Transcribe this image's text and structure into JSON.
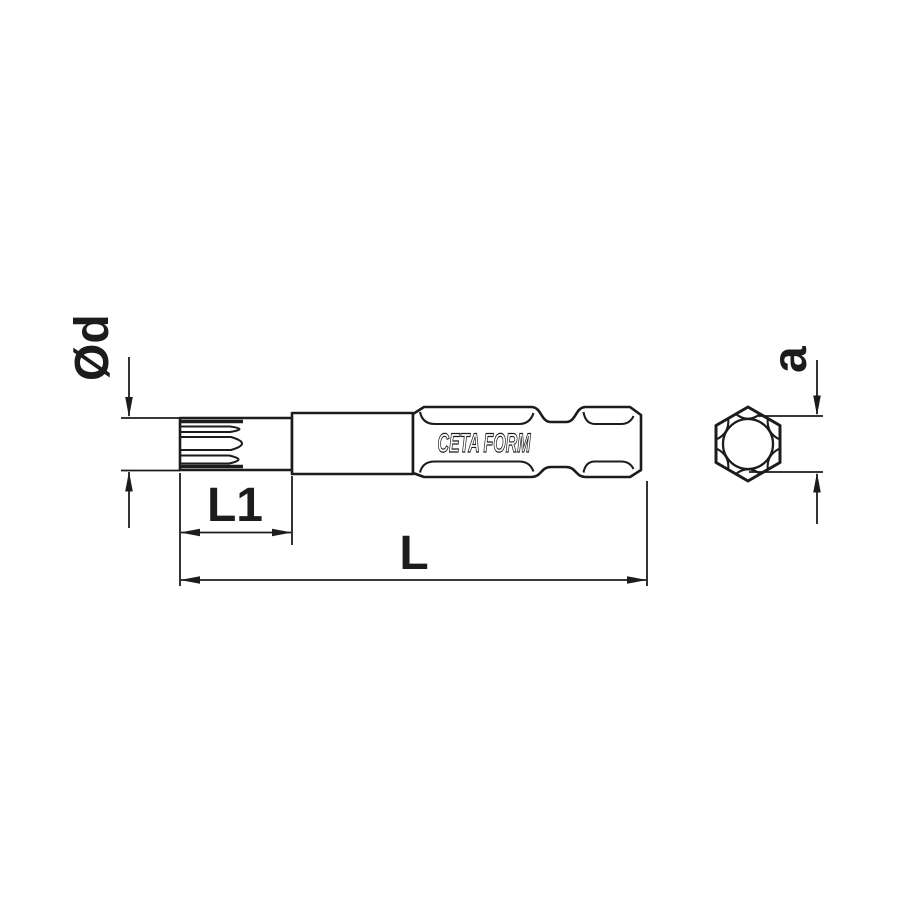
{
  "drawing": {
    "type": "technical-dimension-drawing",
    "subject": "screwdriver power bit with spline tip and hex shank",
    "brand": "CETA FORM",
    "labels": {
      "diameter": "Ød",
      "tip_length": "L1",
      "total_length": "L",
      "hex_width": "a"
    },
    "colors": {
      "line": "#1c1c1c",
      "background": "#ffffff"
    }
  }
}
